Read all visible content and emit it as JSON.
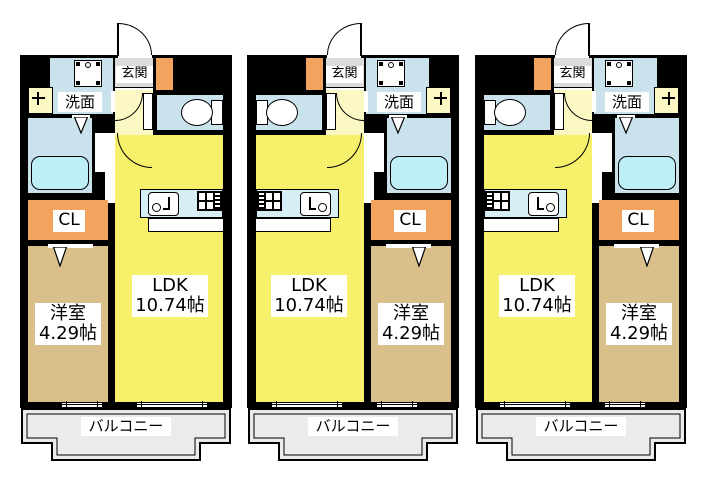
{
  "floor_plan": {
    "units": [
      {
        "id": "unit-1",
        "mirrored": false
      },
      {
        "id": "unit-2",
        "mirrored": true
      },
      {
        "id": "unit-3",
        "mirrored": true
      }
    ],
    "labels": {
      "entrance": "玄関",
      "washroom": "洗面",
      "closet": "CL",
      "ldk_name": "LDK",
      "ldk_size": "10.74帖",
      "bedroom_name": "洋室",
      "bedroom_size": "4.29帖",
      "balcony": "バルコニー"
    },
    "colors": {
      "wall": "#000000",
      "ldk_yellow": "#F7F06B",
      "hall_pale_yellow": "#FBF8C4",
      "wet_area_blue": "#C9E2EC",
      "bathtub_cyan": "#BEEFF6",
      "kitchen_counter_cyan": "#D8EEF6",
      "bedroom_tan": "#D9C08A",
      "closet_orange": "#F2A45F",
      "entrance_gray": "#DBDBDB",
      "balcony_gray": "#EBEBEB"
    }
  }
}
